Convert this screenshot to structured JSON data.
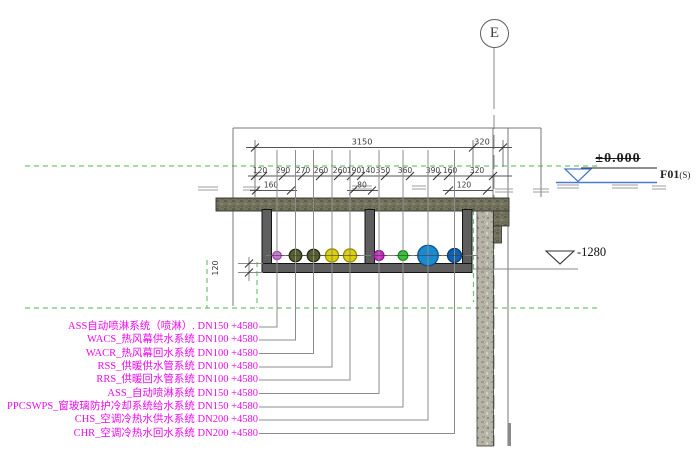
{
  "grid": {
    "label": "E"
  },
  "levels": {
    "zero": {
      "value": "±0.000",
      "name": "F01",
      "suffix": "(S)",
      "line_color": "#4a7bd0"
    },
    "minus": {
      "value": "-1280"
    }
  },
  "dimensions": {
    "vertical_label": "120",
    "rows": [
      {
        "y": 147.5,
        "fs": 8.2,
        "x_start": 246,
        "x_end": 512,
        "ticks": [
          255,
          473,
          503
        ],
        "labels": [
          {
            "t": "3150",
            "x": 362
          },
          {
            "t": "320",
            "x": 482
          }
        ]
      },
      {
        "y": 176,
        "fs": 7.6,
        "x_start": 248,
        "x_end": 512,
        "ticks": [
          255,
          263,
          283,
          302,
          320,
          338,
          351,
          361,
          385,
          410,
          437,
          448,
          470,
          493
        ],
        "labels": [
          {
            "t": "120",
            "x": 260
          },
          {
            "t": "290",
            "x": 283
          },
          {
            "t": "270",
            "x": 303
          },
          {
            "t": "260",
            "x": 321
          },
          {
            "t": "260",
            "x": 340
          },
          {
            "t": "190",
            "x": 354
          },
          {
            "t": "140",
            "x": 368
          },
          {
            "t": "350",
            "x": 383
          },
          {
            "t": "360",
            "x": 405
          },
          {
            "t": "390",
            "x": 433
          },
          {
            "t": "160",
            "x": 450
          },
          {
            "t": "320",
            "x": 477
          }
        ]
      },
      {
        "y": 190.5,
        "fs": 7.6,
        "split": true,
        "segments": [
          {
            "label": "160",
            "x1": 256,
            "x2": 291,
            "lx": 271
          },
          {
            "label": "80",
            "x1": 353,
            "x2": 372,
            "lx": 362
          },
          {
            "label": "120",
            "x1": 449,
            "x2": 487,
            "lx": 464
          }
        ]
      }
    ]
  },
  "pipes": [
    {
      "x": 277,
      "r": 4.2,
      "fill": "#cf7fd8",
      "stroke": "#a438b8"
    },
    {
      "x": 295.5,
      "r": 6.3,
      "fill": "#55602f",
      "stroke": "#20240f"
    },
    {
      "x": 313.5,
      "r": 6.3,
      "fill": "#55602f",
      "stroke": "#20240f"
    },
    {
      "x": 332,
      "r": 6.6,
      "fill": "#ddd104",
      "stroke": "#8f8a00"
    },
    {
      "x": 350,
      "r": 6.6,
      "fill": "#ddd104",
      "stroke": "#8f8a00"
    },
    {
      "x": 379,
      "r": 5.0,
      "fill": "#cb2fc6",
      "stroke": "#8d1589"
    },
    {
      "x": 403,
      "r": 4.9,
      "fill": "#2ec832",
      "stroke": "#118a14"
    },
    {
      "x": 428,
      "r": 10.3,
      "fill": "#1d86d2",
      "stroke": "#0b4e86",
      "inner": {
        "r": 6.8,
        "stroke": "#00a8a8"
      }
    },
    {
      "x": 454.5,
      "r": 7.0,
      "fill": "#0f62b0",
      "stroke": "#073a6e"
    }
  ],
  "systems": [
    {
      "text": "ASS自动喷淋系统（喷淋）. DN150 +4580",
      "y": 327
    },
    {
      "text": "WACS_热风幕供水系统 DN100 +4580",
      "y": 340
    },
    {
      "text": "WACR_热风幕回水系统 DN100 +4580",
      "y": 353.5
    },
    {
      "text": "RSS_供暖供水管系统 DN100 +4580",
      "y": 367
    },
    {
      "text": "RRS_供暖回水管系统 DN100 +4580",
      "y": 380
    },
    {
      "text": "ASS_自动喷淋系统 DN150 +4580",
      "y": 393.5
    },
    {
      "text": "PPCSWPS_窗玻璃防护冷却系统给水系统 DN150 +4580",
      "y": 407
    },
    {
      "text": "CHS_空调冷热水供水系统 DN200 +4580",
      "y": 420
    },
    {
      "text": "CHR_空调冷热水回水系统 DN200 +4580",
      "y": 433.5
    }
  ],
  "colors": {
    "label_magenta": "#ee0aee",
    "datum_green": "#72c472"
  }
}
